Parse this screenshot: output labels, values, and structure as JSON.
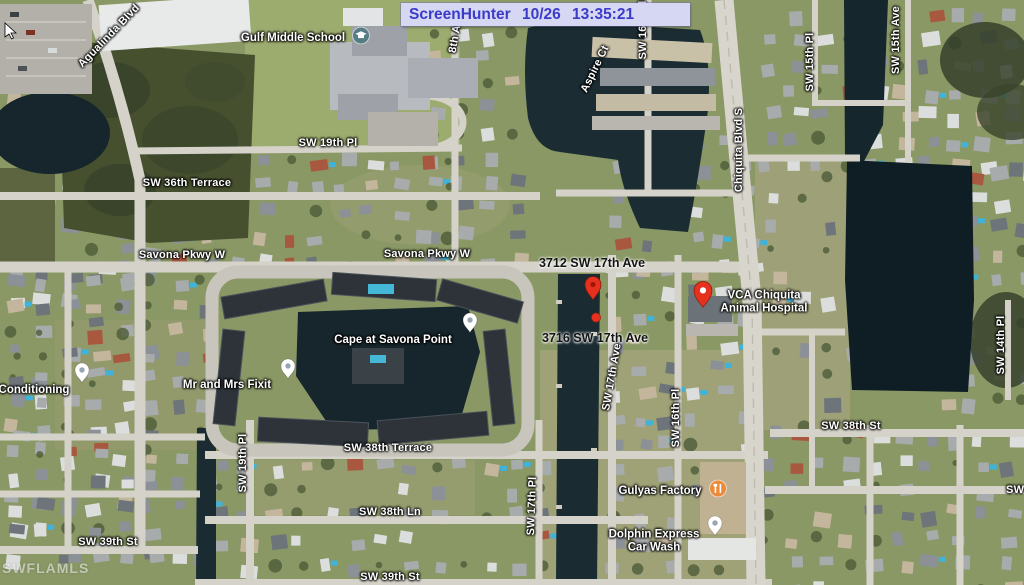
{
  "overlay": {
    "screenhunter_text": "ScreenHunter 10/26 13:35:21"
  },
  "watermark": {
    "text": "SWFLAMLS"
  },
  "map": {
    "street_labels": [
      {
        "text": "Agualinda Blvd",
        "x": 109,
        "y": 36,
        "rot": -46
      },
      {
        "text": "SW 19th Pl",
        "x": 328,
        "y": 143,
        "rot": 0
      },
      {
        "text": "SW 36th Terrace",
        "x": 187,
        "y": 183,
        "rot": 0
      },
      {
        "text": "Savona Pkwy W",
        "x": 182,
        "y": 255,
        "rot": 0
      },
      {
        "text": "Savona Pkwy W",
        "x": 427,
        "y": 254,
        "rot": 0
      },
      {
        "text": "8th Ave",
        "x": 456,
        "y": 33,
        "rot": -80
      },
      {
        "text": "Aspire Ct",
        "x": 595,
        "y": 69,
        "rot": -64
      },
      {
        "text": "SW 16th Pl",
        "x": 643,
        "y": 30,
        "rot": -90
      },
      {
        "text": "Chiquita Blvd S",
        "x": 739,
        "y": 150,
        "rot": -90
      },
      {
        "text": "SW 15th Pl",
        "x": 810,
        "y": 62,
        "rot": -90
      },
      {
        "text": "SW 15th Ave",
        "x": 896,
        "y": 40,
        "rot": -90
      },
      {
        "text": "SW 17th Ave",
        "x": 612,
        "y": 377,
        "rot": -80
      },
      {
        "text": "SW 16th Pl",
        "x": 676,
        "y": 418,
        "rot": -90
      },
      {
        "text": "SW 14th Pl",
        "x": 1001,
        "y": 345,
        "rot": -90
      },
      {
        "text": "SW 19th Pl",
        "x": 243,
        "y": 463,
        "rot": -90
      },
      {
        "text": "SW 17th Pl",
        "x": 532,
        "y": 506,
        "rot": -88
      },
      {
        "text": "SW 38th St",
        "x": 851,
        "y": 426,
        "rot": 0
      },
      {
        "text": "SW 38th Terrace",
        "x": 388,
        "y": 448,
        "rot": 0
      },
      {
        "text": "SW 38th Ln",
        "x": 390,
        "y": 512,
        "rot": 0
      },
      {
        "text": "SW 39th St",
        "x": 108,
        "y": 542,
        "rot": 0
      },
      {
        "text": "SW 39th St",
        "x": 390,
        "y": 577,
        "rot": 0
      },
      {
        "text": "SW 38th Ln",
        "x": 1037,
        "y": 490,
        "rot": 0
      }
    ],
    "place_labels": [
      {
        "name": "gulf-middle-school",
        "lines": [
          "Gulf Middle School"
        ],
        "tx": 293,
        "ty": 38,
        "icon": "school",
        "ix": 361,
        "iy": 38
      },
      {
        "name": "cape-at-savona-point",
        "lines": [
          "Cape at Savona Point"
        ],
        "tx": 393,
        "ty": 340,
        "icon": "pin-white",
        "ix": 470,
        "iy": 338
      },
      {
        "name": "mr-and-mrs-fixit",
        "lines": [
          "Mr and Mrs Fixit"
        ],
        "tx": 227,
        "ty": 385,
        "icon": "pin-white",
        "ix": 288,
        "iy": 384
      },
      {
        "name": "conditioning",
        "lines": [
          "Conditioning"
        ],
        "tx": 34,
        "ty": 390,
        "icon": "pin-white",
        "ix": 82,
        "iy": 388
      },
      {
        "name": "vca-chiquita-animal-hospital",
        "lines": [
          "VCA Chiquita",
          "Animal Hospital"
        ],
        "tx": 764,
        "ty": 302,
        "icon": "pin-red",
        "ix": 703,
        "iy": 313
      },
      {
        "name": "gulyas-factory",
        "lines": [
          "Gulyas Factory"
        ],
        "tx": 660,
        "ty": 491,
        "icon": "restaurant",
        "ix": 718,
        "iy": 491
      },
      {
        "name": "dolphin-express-car-wash",
        "lines": [
          "Dolphin Express",
          "Car Wash"
        ],
        "tx": 654,
        "ty": 541,
        "icon": "pin-white",
        "ix": 715,
        "iy": 541
      }
    ],
    "address_labels": [
      {
        "text": "3712 SW 17th Ave",
        "x": 592,
        "y": 263
      },
      {
        "text": "3716 SW 17th Ave",
        "x": 595,
        "y": 338
      }
    ],
    "markers": [
      {
        "type": "pin",
        "x": 593,
        "y": 305
      },
      {
        "type": "dot",
        "x": 596,
        "y": 319
      }
    ],
    "colors": {
      "marker_red": "#e6311f",
      "water": "#1a2c32",
      "road": "#d5d3c9",
      "screenhunter_bg": "#d6d7f2",
      "screenhunter_text": "#3b3bca",
      "poi_orange": "#ed8a3a",
      "poi_teal": "#567c84"
    }
  }
}
